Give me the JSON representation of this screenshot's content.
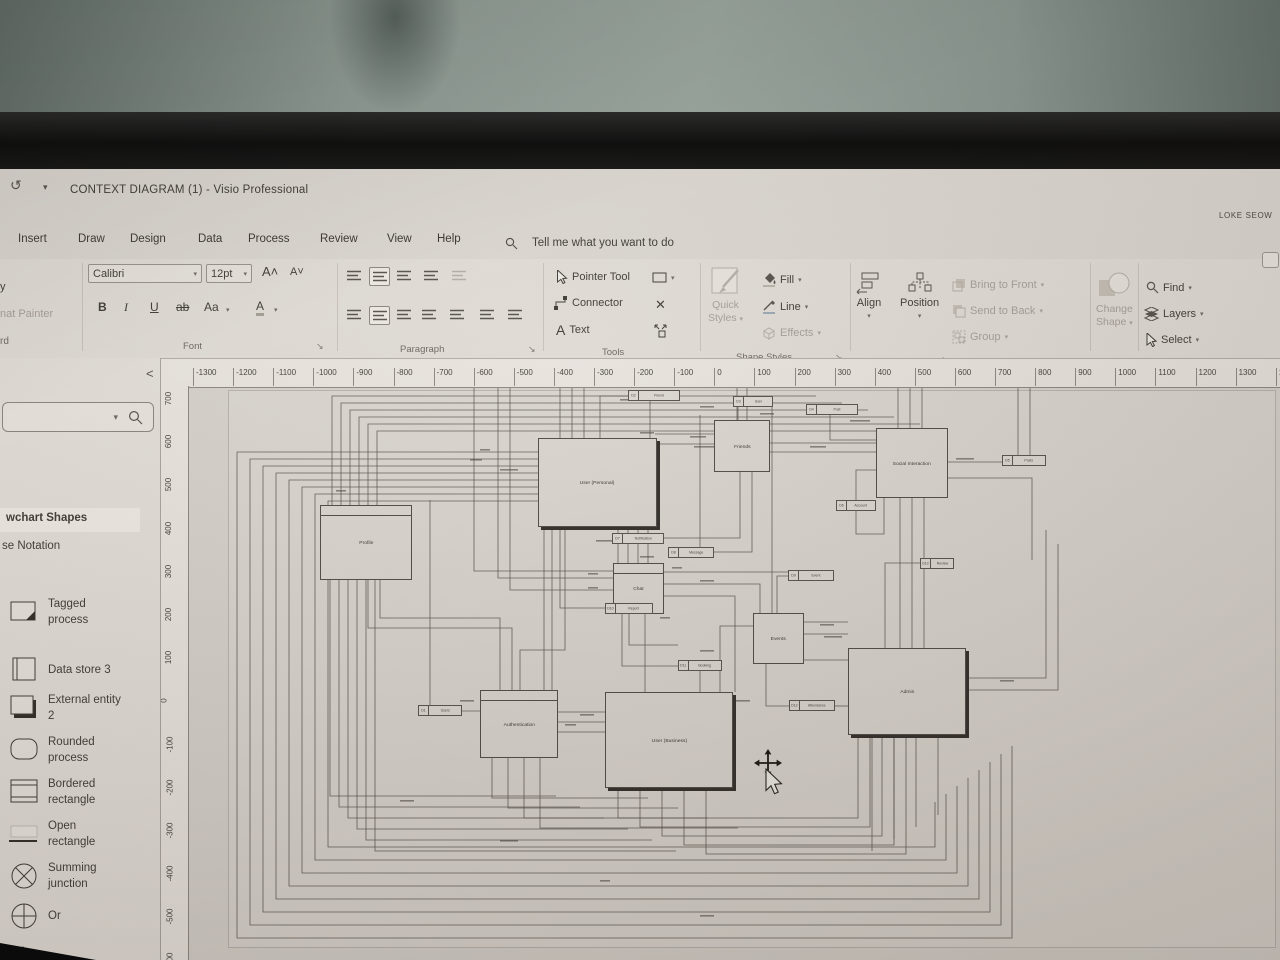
{
  "glyphs": {
    "caret": "▾",
    "launcher": "↘",
    "undo": "↺",
    "close": "✕",
    "collapse": "<",
    "grow": "A˄",
    "shrink": "A˅"
  },
  "window": {
    "title": "CONTEXT DIAGRAM (1)  -  Visio Professional",
    "user": "LOKE SEOW"
  },
  "menu": {
    "tabs": [
      "Insert",
      "Draw",
      "Design",
      "Data",
      "Process",
      "Review",
      "View",
      "Help"
    ],
    "tell_me": "Tell me what you want to do"
  },
  "ribbon": {
    "clipboard": {
      "copy": "y",
      "painter": "nat Painter",
      "label": "rd"
    },
    "font": {
      "family": "Calibri",
      "size": "12pt",
      "bold": "B",
      "italic": "I",
      "underline": "U",
      "strike": "ab",
      "case": "Aa",
      "color": "A",
      "label": "Font"
    },
    "paragraph": {
      "label": "Paragraph"
    },
    "tools": {
      "pointer": "Pointer Tool",
      "connector": "Connector",
      "text": "Text",
      "label": "Tools"
    },
    "shape_styles": {
      "quick_l1": "Quick",
      "quick_l2": "Styles",
      "fill": "Fill",
      "line": "Line",
      "effects": "Effects",
      "label": "Shape Styles"
    },
    "arrange": {
      "align": "Align",
      "position": "Position",
      "bring": "Bring to Front",
      "send": "Send to Back",
      "group": "Group",
      "label": "Arrange"
    },
    "change_shape": {
      "l1": "Change",
      "l2": "Shape"
    },
    "editing": {
      "find": "Find",
      "layers": "Layers",
      "select": "Select",
      "label": "Editing"
    }
  },
  "shapes_panel": {
    "collapse": "<",
    "header": "wchart Shapes",
    "subheader": "se Notation",
    "items": [
      {
        "icon": "tagged-process",
        "label": "Tagged\nprocess"
      },
      {
        "icon": "data-store",
        "label": "Data store 3"
      },
      {
        "icon": "external-entity",
        "label": "External entity\n2"
      },
      {
        "icon": "rounded-process",
        "label": "Rounded\nprocess"
      },
      {
        "icon": "bordered-rectangle",
        "label": "Bordered\nrectangle"
      },
      {
        "icon": "open-rectangle",
        "label": "Open\nrectangle"
      },
      {
        "icon": "summing-junction",
        "label": "Summing\njunction"
      },
      {
        "icon": "or-circle",
        "label": "Or"
      },
      {
        "icon": "triangle",
        "label": ""
      }
    ]
  },
  "rulers": {
    "horizontal": [
      -1300,
      -1200,
      -1100,
      -1000,
      -900,
      -800,
      -700,
      -600,
      -500,
      -400,
      -300,
      -200,
      -100,
      0,
      100,
      200,
      300,
      400,
      500,
      600,
      700,
      800,
      900,
      1000,
      1100,
      1200,
      1300,
      1400
    ],
    "vertical": [
      700,
      600,
      500,
      400,
      300,
      200,
      100,
      0,
      -100,
      -200,
      -300,
      -400,
      -500,
      -600
    ]
  },
  "diagram": {
    "nodes": [
      {
        "id": "user-personal",
        "label": "User (Personal)",
        "x": 538,
        "y": 438,
        "w": 117,
        "h": 87,
        "style": "shadow"
      },
      {
        "id": "friends",
        "label": "Friends",
        "x": 714,
        "y": 420,
        "w": 54,
        "h": 50,
        "style": "plain"
      },
      {
        "id": "social-interaction",
        "label": "Social Interaction",
        "x": 876,
        "y": 428,
        "w": 70,
        "h": 68,
        "style": "plain"
      },
      {
        "id": "profile",
        "label": "Profile",
        "x": 320,
        "y": 505,
        "w": 90,
        "h": 73,
        "style": "header"
      },
      {
        "id": "chat",
        "label": "Chat",
        "x": 613,
        "y": 563,
        "w": 49,
        "h": 49,
        "style": "header"
      },
      {
        "id": "events",
        "label": "Events",
        "x": 753,
        "y": 613,
        "w": 49,
        "h": 49,
        "style": "plain"
      },
      {
        "id": "admin",
        "label": "Admin",
        "x": 848,
        "y": 648,
        "w": 116,
        "h": 85,
        "style": "shadow"
      },
      {
        "id": "authentication",
        "label": "Authentication",
        "x": 480,
        "y": 690,
        "w": 76,
        "h": 66,
        "style": "header"
      },
      {
        "id": "user-business",
        "label": "User (Business)",
        "x": 605,
        "y": 692,
        "w": 126,
        "h": 94,
        "style": "shadow"
      }
    ],
    "stores": [
      {
        "id": "D1",
        "label": "Users",
        "x": 418,
        "y": 705,
        "w": 44
      },
      {
        "id": "D2",
        "label": "Friend",
        "x": 628,
        "y": 390,
        "w": 52
      },
      {
        "id": "D3",
        "label": "User",
        "x": 733,
        "y": 396,
        "w": 40
      },
      {
        "id": "D4",
        "label": "Post",
        "x": 806,
        "y": 404,
        "w": 52
      },
      {
        "id": "D5",
        "label": "Posts",
        "x": 1002,
        "y": 455,
        "w": 44
      },
      {
        "id": "D6",
        "label": "Account",
        "x": 836,
        "y": 500,
        "w": 40
      },
      {
        "id": "D7",
        "label": "Notification",
        "x": 612,
        "y": 533,
        "w": 52
      },
      {
        "id": "D8",
        "label": "Message",
        "x": 668,
        "y": 547,
        "w": 46
      },
      {
        "id": "D9",
        "label": "Event",
        "x": 788,
        "y": 570,
        "w": 46
      },
      {
        "id": "D10",
        "label": "Report",
        "x": 605,
        "y": 603,
        "w": 48
      },
      {
        "id": "D11",
        "label": "Booking",
        "x": 678,
        "y": 660,
        "w": 44
      },
      {
        "id": "D12",
        "label": "Attendance",
        "x": 789,
        "y": 700,
        "w": 46
      },
      {
        "id": "D13",
        "label": "Review",
        "x": 920,
        "y": 558,
        "w": 34
      }
    ]
  }
}
